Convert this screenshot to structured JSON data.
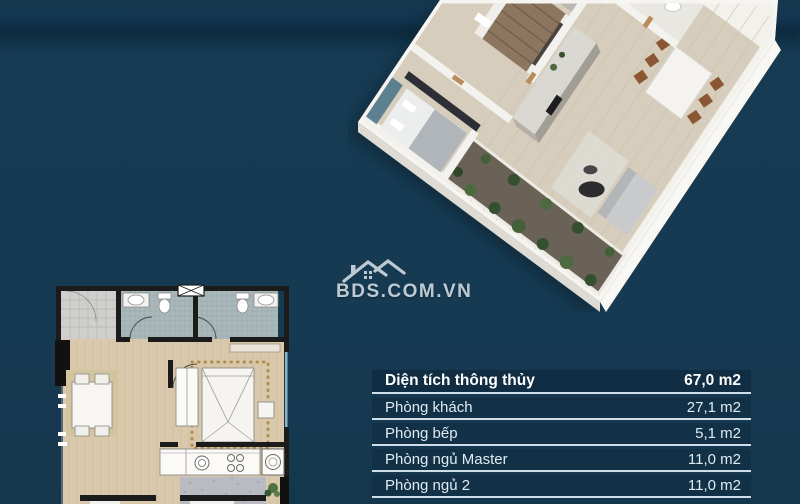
{
  "watermark": {
    "text": "BDS.COM.VN",
    "icon": "house-roof-icon",
    "color": "#cdd7de"
  },
  "area_table": {
    "header": {
      "label": "Diện tích thông thủy",
      "value": "67,0 m2"
    },
    "rows": [
      {
        "label": "Phòng khách",
        "value": "27,1 m2"
      },
      {
        "label": "Phòng bếp",
        "value": "5,1 m2"
      },
      {
        "label": "Phòng ngủ Master",
        "value": "11,0 m2"
      },
      {
        "label": "Phòng ngủ 2",
        "value": "11,0 m2"
      }
    ]
  },
  "colors": {
    "background": "#163a52",
    "table_row_bg": "#123147",
    "table_header_bg": "#102d43",
    "table_separator": "#cfdfe9",
    "text_light": "#dfebf3",
    "wood_floor": "#d6cdbc",
    "plan_wall": "#1b1b1b",
    "balcony_green": "#44603a"
  }
}
